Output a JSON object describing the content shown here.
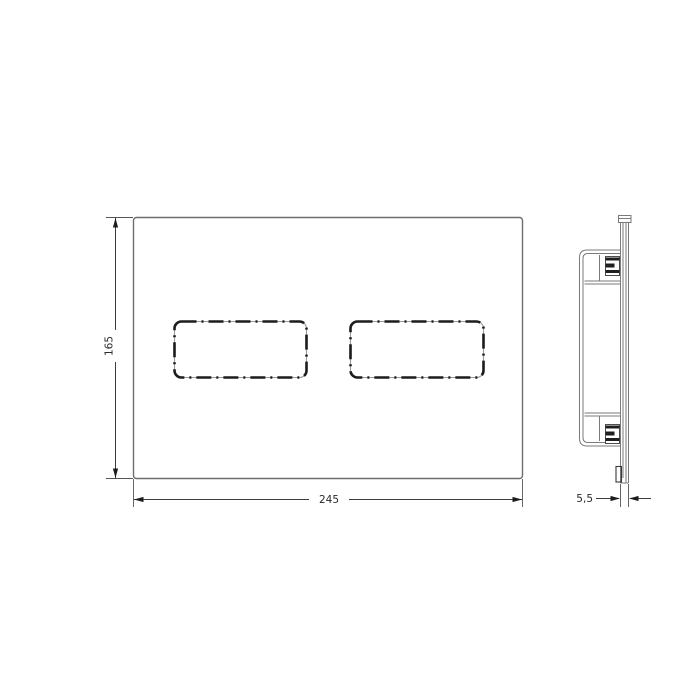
{
  "dimensions": {
    "height": "165",
    "width": "245",
    "thickness": "5,5"
  },
  "front_view": {
    "button_count": 2
  },
  "colors": {
    "background": "#ffffff",
    "plate_outline": "#6e6e6e",
    "button_dash": "#1c1c1c",
    "dimension_line": "#3c3c3c",
    "dimension_text": "#2a2a2a"
  }
}
